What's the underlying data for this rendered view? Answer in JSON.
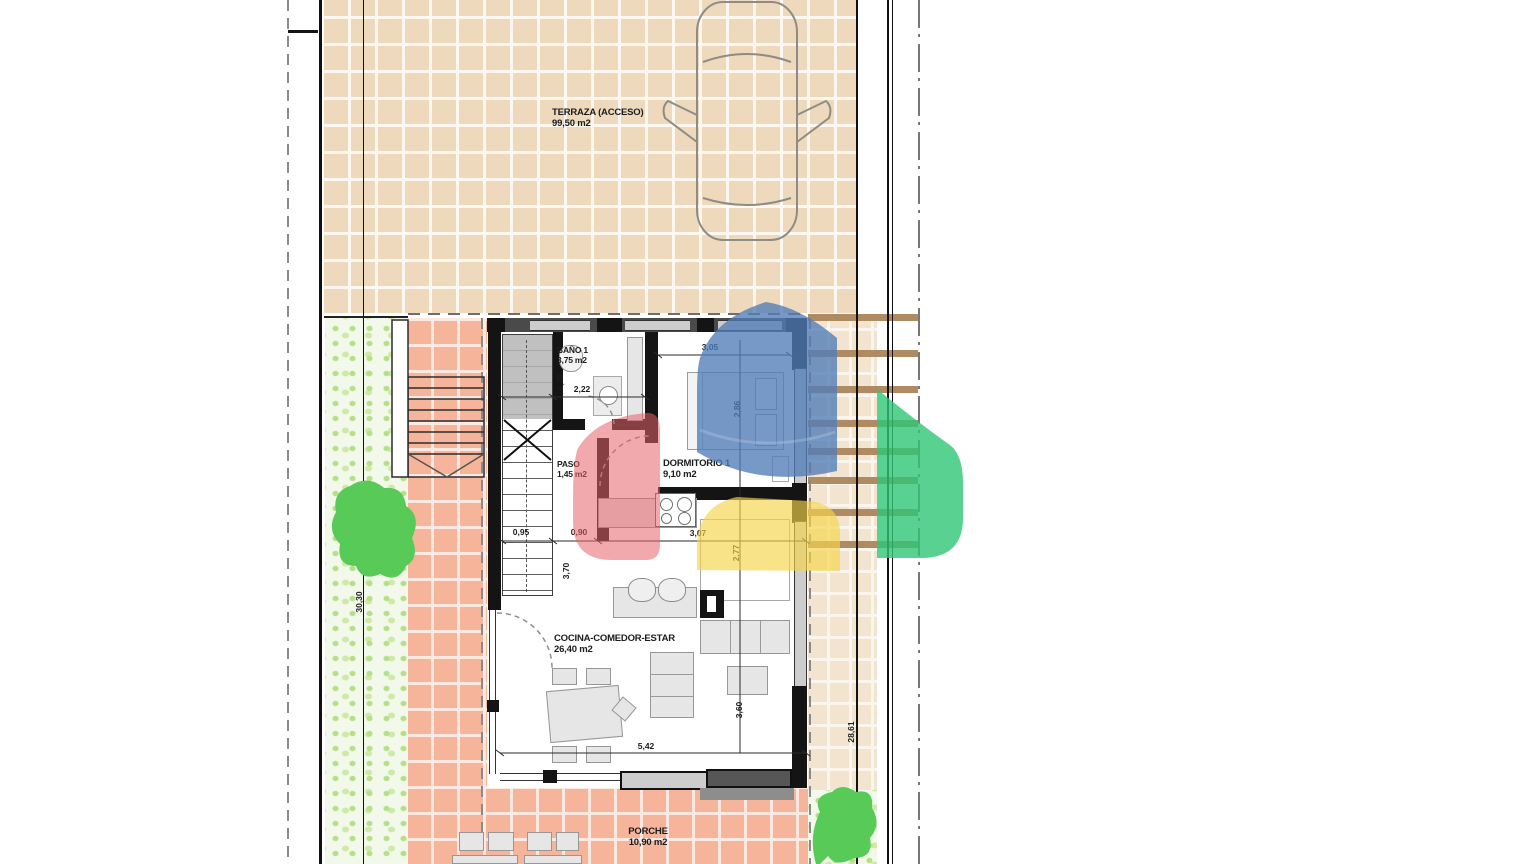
{
  "plan_title": "floor-plan",
  "rooms": [
    {
      "name": "TERRAZA (ACCESO)",
      "area": "99,50 m2"
    },
    {
      "name": "BAÑO 1",
      "area": "3,75 m2"
    },
    {
      "name": "PASO",
      "area": "1,45 m2"
    },
    {
      "name": "DORMITORIO 1",
      "area": "9,10 m2"
    },
    {
      "name": "COCINA-COMEDOR-ESTAR",
      "area": "26,40 m2"
    },
    {
      "name": "PORCHE",
      "area": "10,90 m2"
    }
  ],
  "dimensions": {
    "bano_width": "2,22",
    "bano_side": "1,70",
    "dorm_width": "3,05",
    "dorm_depth": "2,86",
    "stair_width": "0,95",
    "paso_width": "0,90",
    "kitchen_width": "3,07",
    "paso_length": "3,70",
    "kitchen_depth": "2,77",
    "cocina_width": "5,42",
    "cocina_depth": "3,60",
    "plot_left": "30,30",
    "plot_right": "28,61"
  },
  "overlays": [
    {
      "name": "view-cone-blue",
      "color": "#4f7cb8"
    },
    {
      "name": "view-cone-red",
      "color": "#e8636b"
    },
    {
      "name": "view-cone-yellow",
      "color": "#f6d44c"
    },
    {
      "name": "view-cone-green",
      "color": "#2fc674"
    }
  ],
  "colors": {
    "terrace_tile": "#eed9bc",
    "path_tile": "#f6b49b",
    "garden_base": "#f2f8ea",
    "garden_dot": "#b4e088",
    "bush": "#57ca57",
    "pergola_bar": "#b08a63",
    "wall": "#141414"
  }
}
